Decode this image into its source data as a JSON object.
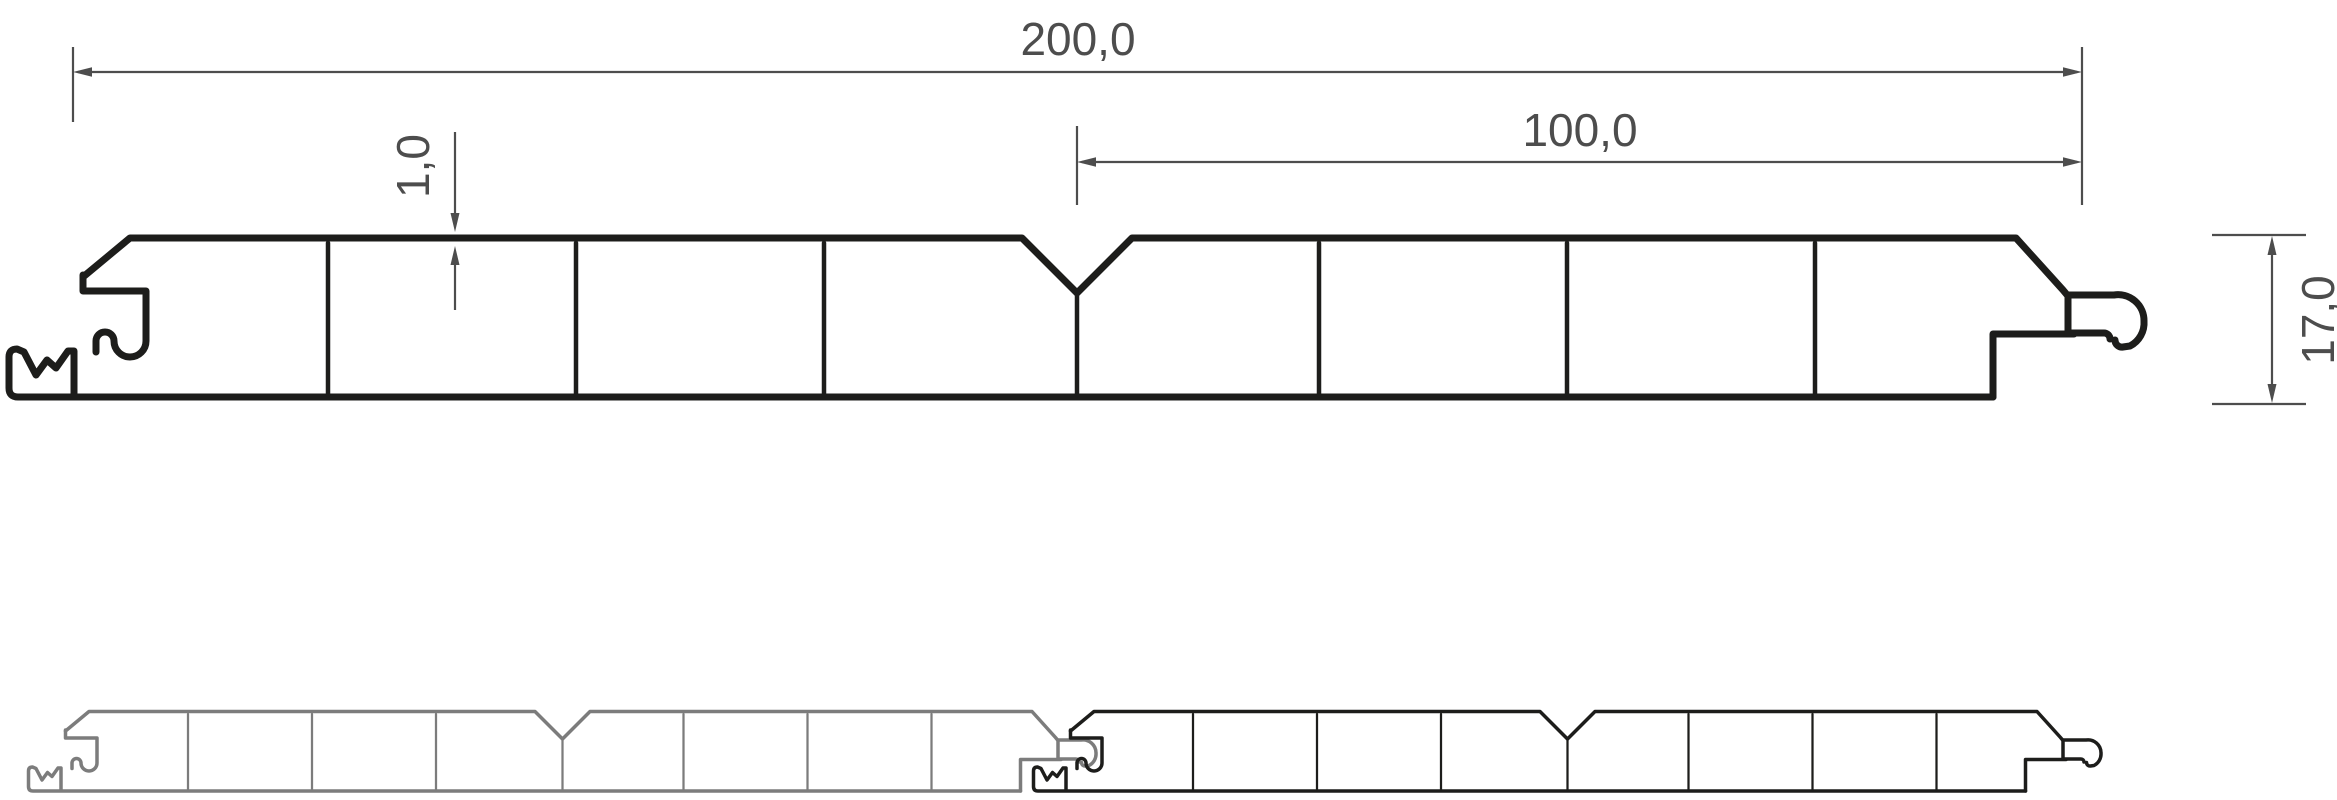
{
  "page": {
    "background": "#ffffff",
    "kind": "technical profile cross-section drawing"
  },
  "colors": {
    "profile_line": "#1d1d1b",
    "dimension_line": "#4d4d4d",
    "joined_panel_left": "#7c7c7c",
    "joined_panel_right": "#1d1d1b"
  },
  "dimensions": {
    "overall_width_mm": "200,0",
    "half_width_mm": "100,0",
    "wall_thickness_mm": "1,0",
    "profile_height_mm": "17,0"
  }
}
